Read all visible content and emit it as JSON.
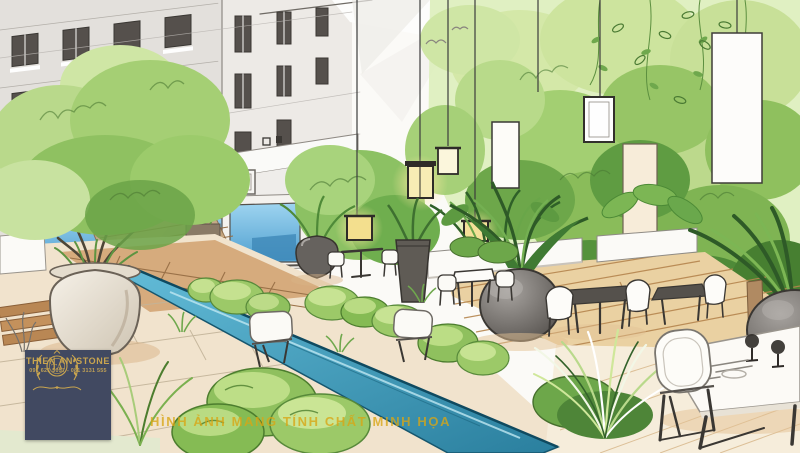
{
  "scene": {
    "description": "Hand-drawn marker and watercolor concept sketch of a courtyard roof-garden cafe beside a building",
    "elements": [
      "building-facade",
      "storefront-glass",
      "tree-in-urn",
      "hanging-lanterns",
      "light-panels",
      "water-rill",
      "moss-mounds",
      "wood-deck",
      "cafe-tables",
      "foliage-wall"
    ],
    "palette": {
      "paper": "#fbfaf7",
      "building_gray": "#e3e0dc",
      "sketch_line": "#55504c",
      "glass_blue": "#6fb9e2",
      "green_light": "#cfe3a0",
      "green_mid": "#9cc968",
      "green_deep": "#5d9441",
      "green_dark": "#3e6b2c",
      "water_teal": "#3f9fc0",
      "paving_tan": "#cfa06e",
      "deck_wood": "#ead1a2",
      "pot_cream": "#efe8db",
      "pot_charcoal": "#66625e",
      "lantern_glow": "#f3df8e",
      "shadow_warm": "#e3c194"
    }
  },
  "logo": {
    "brand": "THIEN AN STONE",
    "monogram": "TA",
    "phone": "091 621 5057 - 081 3131 555",
    "background": "#414961",
    "gold": "#c9a54f"
  },
  "watermark": {
    "text": "HÌNH ẢNH MANG TÍNH CHẤT MINH HỌA",
    "color": "#d9a614"
  }
}
